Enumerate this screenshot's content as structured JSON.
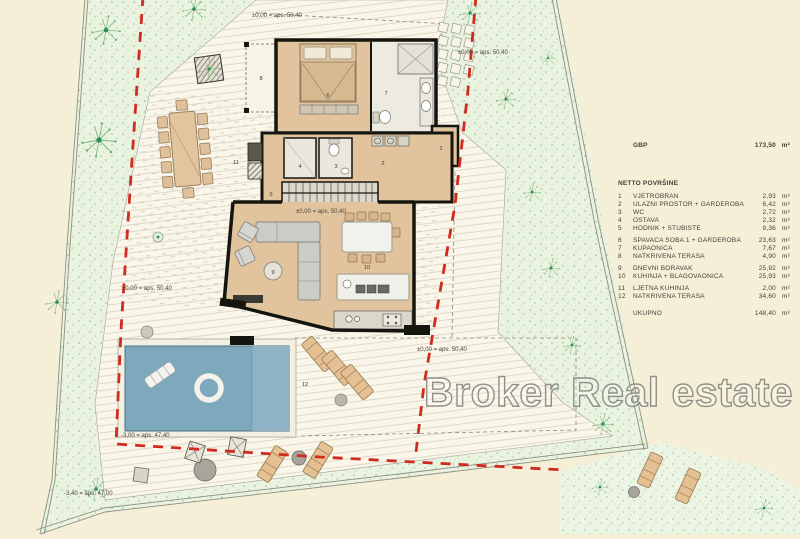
{
  "plan": {
    "watermark": "Broker Real estate",
    "elevations": {
      "zero": "±0,00 = aps. 50,40",
      "minus300": "-3,00 = aps. 47,40",
      "minus340": "-3,40 = aps. 47,00"
    },
    "room_numbers": [
      "1",
      "2",
      "3",
      "4",
      "5",
      "6",
      "7",
      "8",
      "9",
      "10",
      "11",
      "12"
    ]
  },
  "legend": {
    "gbp_label": "GBP",
    "gbp_value": "173,50",
    "unit": "m²",
    "section_title": "NETTO POVRŠINE",
    "rooms": [
      {
        "no": "1",
        "name": "VJETROBRAN",
        "value": "2,93"
      },
      {
        "no": "2",
        "name": "ULAZNI PROSTOR + GARDEROBA",
        "value": "6,42"
      },
      {
        "no": "3",
        "name": "WC",
        "value": "2,72"
      },
      {
        "no": "4",
        "name": "OSTAVA",
        "value": "2,32"
      },
      {
        "no": "5",
        "name": "HODNIK + STUBIŠTE",
        "value": "9,36"
      },
      {
        "no": "6",
        "name": "SPAVAĆA SOBA 1 + GARDEROBA",
        "value": "23,63"
      },
      {
        "no": "7",
        "name": "KUPAONICA",
        "value": "7,67"
      },
      {
        "no": "8",
        "name": "NATKRIVENA TERASA",
        "value": "4,90"
      },
      {
        "no": "9",
        "name": "DNEVNI BORAVAK",
        "value": "25,92"
      },
      {
        "no": "10",
        "name": "KUHINJA + BLAGOVAONICA",
        "value": "25,93"
      },
      {
        "no": "11",
        "name": "LJETNA KUHINJA",
        "value": "2,00"
      },
      {
        "no": "12",
        "name": "NATKRIVENA TERASA",
        "value": "34,60"
      }
    ],
    "total_label": "UKUPNO",
    "total_value": "148,40"
  },
  "colors": {
    "paper_cream": "#f6efd8",
    "vegetation_green": "#e9f3e0",
    "floor_tan": "#e1c49e",
    "pool_blue": "#7ea8bc",
    "boundary_red": "#cf2b20",
    "wall_black": "#15150f"
  }
}
